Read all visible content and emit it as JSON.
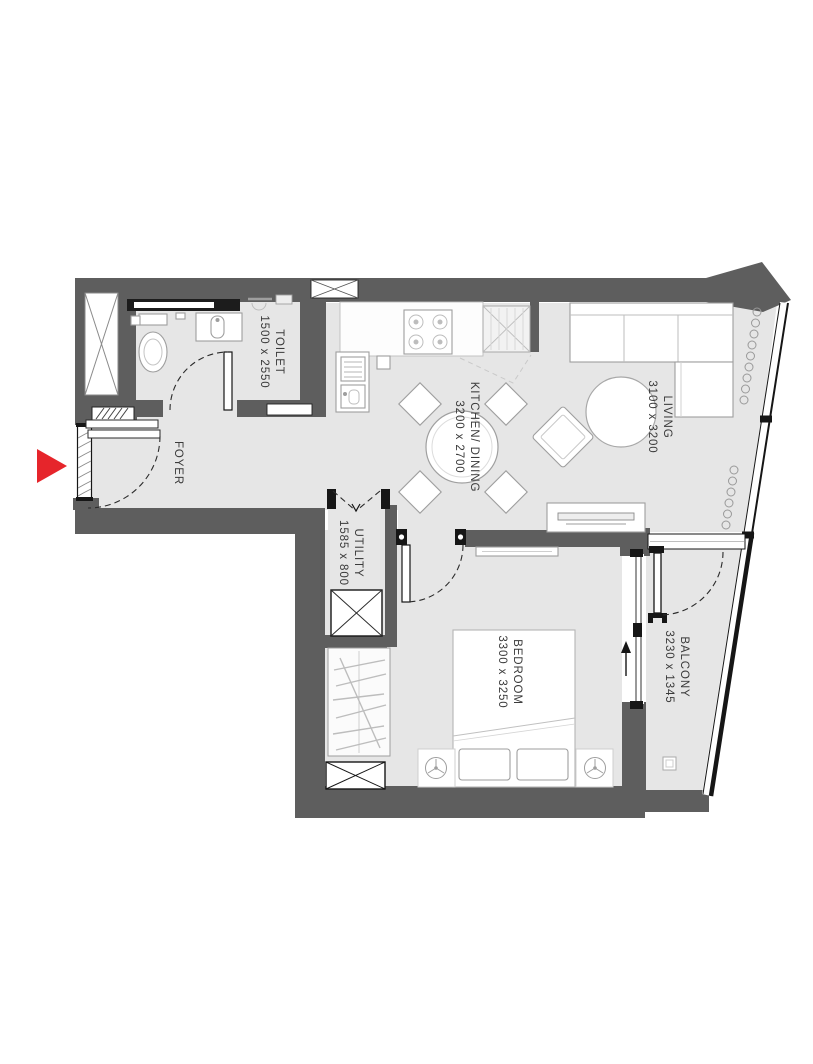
{
  "plan": {
    "type": "apartment-floor-plan",
    "rooms": {
      "toilet": {
        "name": "TOILET",
        "dims": "1500 x 2550"
      },
      "foyer": {
        "name": "FOYER",
        "dims": ""
      },
      "kitchen_dining": {
        "name": "KITCHEN/ DINING",
        "dims": "3200 x 2700"
      },
      "living": {
        "name": "LIVING",
        "dims": "3100 x 3200"
      },
      "utility": {
        "name": "UTILITY",
        "dims": "1585 x 800"
      },
      "bedroom": {
        "name": "BEDROOM",
        "dims": "3300 x 3250"
      },
      "balcony": {
        "name": "BALCONY",
        "dims": "3230 x 1345"
      }
    },
    "colors": {
      "wall": "#5e5e5e",
      "floor": "#e6e6e6",
      "floor_toilet": "#e9e9e9",
      "accent_red": "#e6252b",
      "line_dark": "#161616"
    }
  }
}
